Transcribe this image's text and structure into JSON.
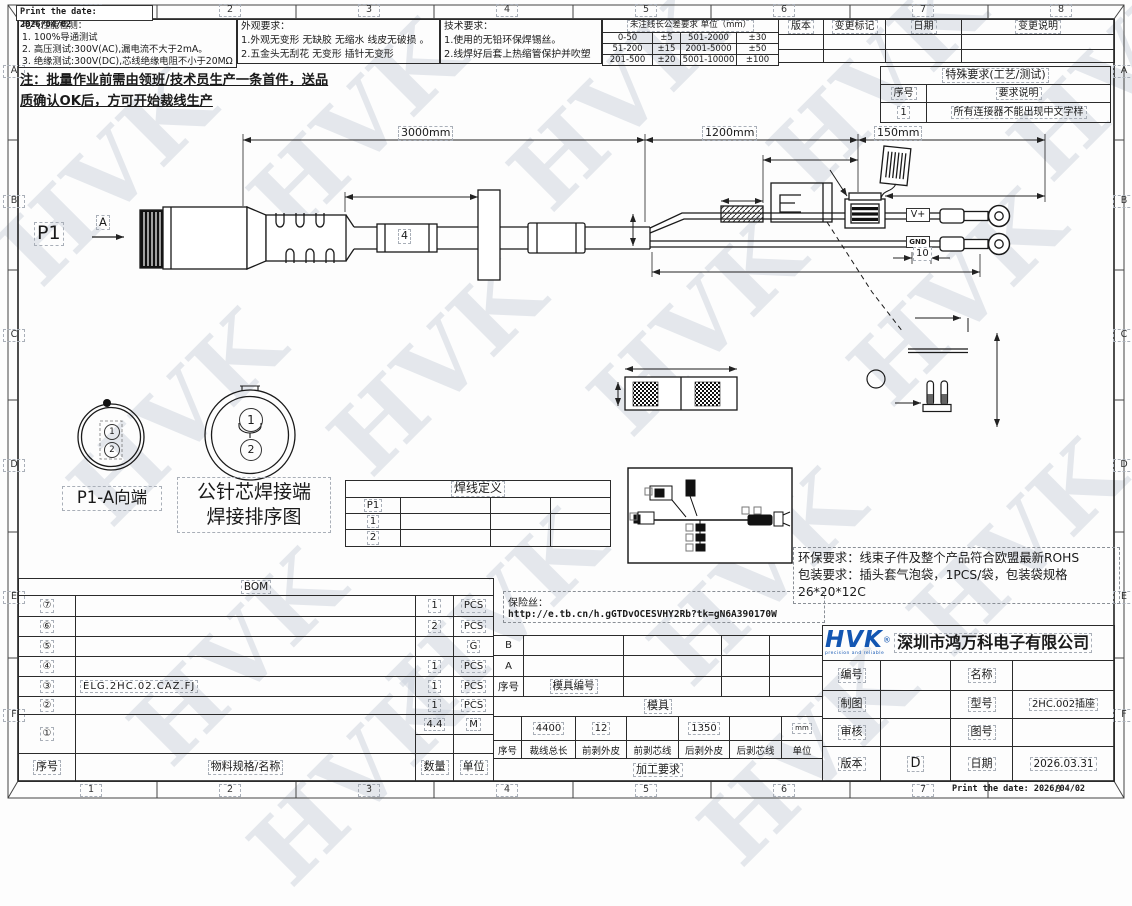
{
  "meta": {
    "print_date": "Print the date: 2026/04/02"
  },
  "grid": {
    "cols": [
      "1",
      "2",
      "3",
      "4",
      "5",
      "6",
      "7",
      "8"
    ],
    "rows": [
      "A",
      "B",
      "C",
      "D",
      "E",
      "F"
    ]
  },
  "header": {
    "electrical": {
      "title": "电气性能检测：",
      "item1": "1. 100%导通测试",
      "item2": "2. 高压测试:300V(AC),漏电流不大于2mA。",
      "item3": "3. 绝缘测试:300V(DC),芯线绝缘电阻不小于20MΩ"
    },
    "appearance": {
      "title": "外观要求：",
      "item1": "1.外观无变形 无缺胶 无缩水 线皮无破损 。",
      "item2": "2.五金头无刮花 无变形 插针无变形"
    },
    "technical": {
      "title": "技术要求：",
      "item1": "1.使用的无铅环保焊锡丝。",
      "item2": "2.线焊好后套上热缩管保护并吹塑"
    },
    "tolerance": {
      "title": "未注线长公差要求 单位（mm）",
      "rows": [
        [
          "0-50",
          "±5",
          "501-2000",
          "±30"
        ],
        [
          "51-200",
          "±15",
          "2001-5000",
          "±50"
        ],
        [
          "201-500",
          "±20",
          "5001-10000",
          "±100"
        ]
      ]
    },
    "revision": {
      "cols": [
        "版本",
        "变更标记",
        "日期",
        "变更说明"
      ]
    }
  },
  "notes": {
    "first_article_line1": "注：批量作业前需由领班/技术员生产一条首件，送品",
    "first_article_line2": "质确认OK后，方可开始裁线生产",
    "special": {
      "title": "特殊要求(工艺/测试)",
      "col_no": "序号",
      "col_desc": "要求说明",
      "row_no": "1",
      "row_desc": "所有连接器不能出现中文字样"
    },
    "env_line1": "环保要求：线束子件及整个产品符合欧盟最新ROHS",
    "env_line2": "包装要求：插头套气泡袋，1PCS/袋，包装袋规格",
    "env_line3": "26*20*12C",
    "fuse_label": "保险丝：",
    "fuse_url": "http://e.tb.cn/h.gGTDvOCESVHY2Rb?tk=gN6A390170W"
  },
  "drawing": {
    "p1": "P1",
    "section_a": "A",
    "dim_total": "3000mm",
    "dim_mid": "1200mm",
    "dim_end": "150mm",
    "marker": "4",
    "label_vplus": "V+",
    "label_gnd": "GND",
    "dim_small": "10",
    "pin1": "1",
    "pin2": "2",
    "view_small_label": "P1-A向端",
    "view_big_label1": "公针芯焊接端",
    "view_big_label2": "焊接排序图"
  },
  "weld_table": {
    "title": "焊线定义",
    "r1c1": "P1",
    "r2c1": "1",
    "r3c1": "2"
  },
  "bom": {
    "title": "BOM",
    "rows": [
      {
        "no": "⑦",
        "spec": "",
        "qty": "1",
        "unit": "PCS"
      },
      {
        "no": "⑥",
        "spec": "",
        "qty": "2",
        "unit": "PCS"
      },
      {
        "no": "⑤",
        "spec": "",
        "qty": "",
        "unit": "G"
      },
      {
        "no": "④",
        "spec": "",
        "qty": "1",
        "unit": "PCS"
      },
      {
        "no": "③",
        "spec": "ELG.2HC.02.CAZ.FJ",
        "qty": "1",
        "unit": "PCS"
      },
      {
        "no": "②",
        "spec": "",
        "qty": "1",
        "unit": "PCS"
      },
      {
        "no": "①",
        "spec": "",
        "qty": "4.4",
        "unit": "M"
      }
    ],
    "footer": [
      "序号",
      "物料规格/名称",
      "数量",
      "单位"
    ]
  },
  "mold": {
    "row_b": "B",
    "row_a": "A",
    "col_no": "序号",
    "col_id": "模具编号",
    "title": "模具"
  },
  "process": {
    "v_total": "4400",
    "v_front_jacket": "12",
    "v_rear_jacket": "1350",
    "v_unit": "mm",
    "headers": [
      "序号",
      "裁线总长",
      "前剥外皮",
      "前剥芯线",
      "后剥外皮",
      "后剥芯线",
      "单位"
    ],
    "title": "加工要求"
  },
  "title_block": {
    "logo": "HVK",
    "logo_mark": "®",
    "logo_tagline": "precision and reliable",
    "company": "深圳市鸿万科电子有限公司",
    "f_code_label": "编号",
    "f_code": "",
    "f_name_label": "名称",
    "f_name": "",
    "f_draw_label": "制图",
    "f_draw": "",
    "f_model_label": "型号",
    "f_model": "2HC.002插座",
    "f_check_label": "审核",
    "f_check": "",
    "f_dwgno_label": "图号",
    "f_dwgno": "",
    "f_ver_label": "版本",
    "f_ver": "D",
    "f_date_label": "日期",
    "f_date": "2026.03.31"
  },
  "watermark": "HVK",
  "colors": {
    "logo_blue": "#1356b2",
    "line": "#222222",
    "watermark": "#c9d2dc"
  }
}
